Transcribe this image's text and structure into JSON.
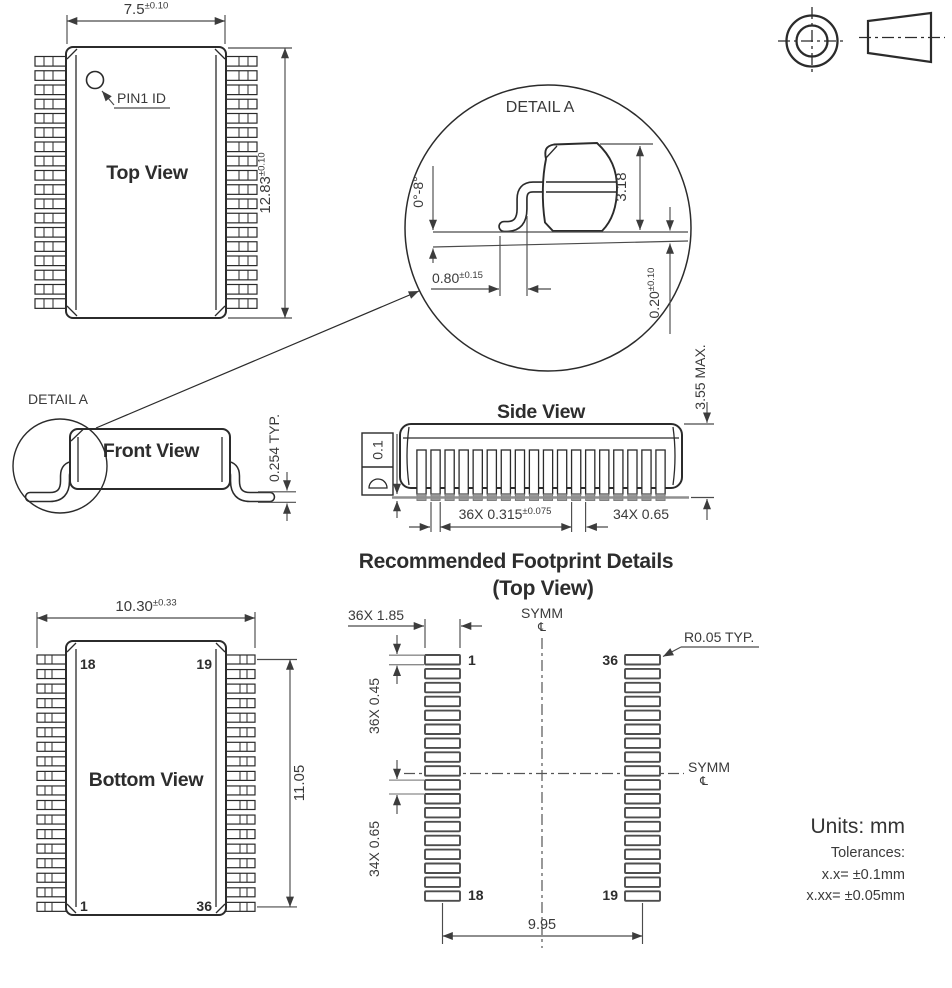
{
  "top_view": {
    "title": "Top View",
    "pin1_label": "PIN1 ID",
    "width": "7.5",
    "width_tol": "±0.10",
    "length": "12.83",
    "length_tol": "±0.10"
  },
  "detail_a": {
    "title": "DETAIL A",
    "lead_angle": "0°-8°",
    "body_thickness": "3.18",
    "foot_length": "0.80",
    "foot_length_tol": "±0.15",
    "standoff": "0.20",
    "standoff_tol": "±0.10"
  },
  "front_view": {
    "detail_callout": "DETAIL A",
    "title": "Front View",
    "lead_thickness": "0.254 TYP."
  },
  "side_view": {
    "title": "Side View",
    "seating_flatness": "0.1",
    "lead_width": "36X 0.315",
    "lead_width_tol": "±0.075",
    "lead_pitch": "34X 0.65",
    "package_height": "3.55 MAX."
  },
  "footprint": {
    "title": "Recommended Footprint Details",
    "subtitle": "(Top View)",
    "pad_length": "36X 1.85",
    "pad_width": "36X 0.45",
    "pad_pitch": "34X 0.65",
    "pad_corner_radius": "R0.05 TYP.",
    "pad_row_span": "9.95",
    "symm_label": "SYMM",
    "centerline_symbol": "℄",
    "pin1": "1",
    "pin18": "18",
    "pin19": "19",
    "pin36": "36"
  },
  "bottom_view": {
    "title": "Bottom View",
    "overall_width": "10.30",
    "overall_width_tol": "±0.33",
    "pin_span": "11.05",
    "pin18": "18",
    "pin19": "19",
    "pin1": "1",
    "pin36": "36"
  },
  "notes": {
    "units": "Units: mm",
    "tolerances_heading": "Tolerances:",
    "tolerance_1dp": "x.x= ±0.1mm",
    "tolerance_2dp": "x.xx= ±0.05mm"
  }
}
